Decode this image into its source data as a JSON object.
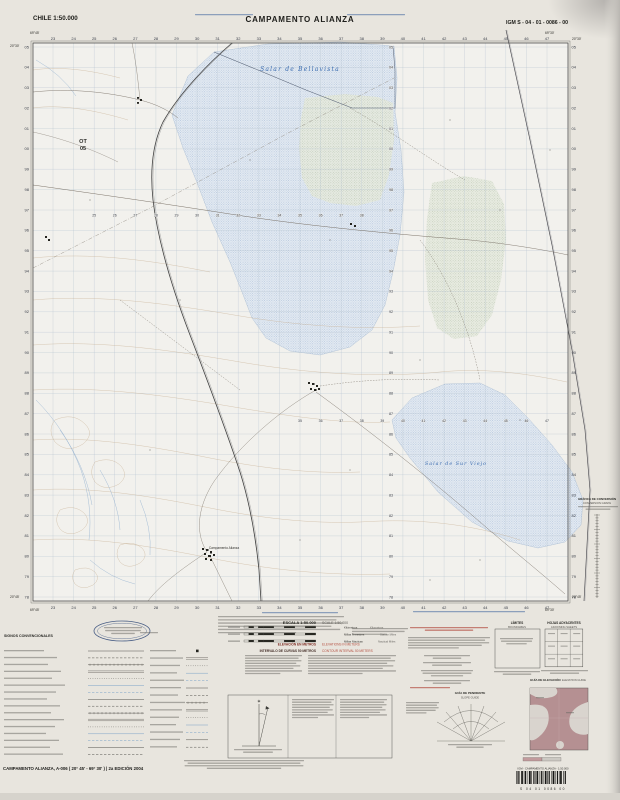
{
  "header": {
    "country_scale": "CHILE 1:50.000",
    "title": "CAMPAMENTO ALIANZA",
    "sheet_code": "IGM S - 04 - 01 - 0086 - 00"
  },
  "map": {
    "neighbor_sheet_ref": {
      "line1": "OT",
      "line2": "05"
    },
    "feature_labels": {
      "salar_north": "Salar de Bellavista",
      "salar_south": "Salar de Sur Viejo",
      "settlement": "Campamento Alianza"
    },
    "corners": {
      "lon_west": "69°45'",
      "lon_east": "69°30'",
      "lat_north": "20°30'",
      "lat_south": "20°45'"
    },
    "grid": {
      "eastings": [
        "23",
        "24",
        "25",
        "26",
        "27",
        "28",
        "29",
        "30",
        "31",
        "32",
        "33",
        "34",
        "35",
        "36",
        "37",
        "38",
        "39",
        "40",
        "41",
        "42",
        "43",
        "44",
        "45",
        "46",
        "47"
      ],
      "northings": [
        "05",
        "04",
        "03",
        "02",
        "01",
        "00",
        "99",
        "98",
        "97",
        "96",
        "95",
        "94",
        "93",
        "92",
        "91",
        "90",
        "89",
        "88",
        "87",
        "86",
        "85",
        "84",
        "83",
        "82",
        "81",
        "80",
        "79",
        "78"
      ]
    }
  },
  "marginalia": {
    "legend_title": "SIGNOS CONVENCIONALES",
    "scale_block": {
      "escala": "ESCALA 1:50.000",
      "scale": "SCALE 1:50,000",
      "bars": [
        {
          "es": "Kilómetros",
          "en": "Kilometers"
        },
        {
          "es": "Millas Terrestres",
          "en": "Statute Miles"
        },
        {
          "es": "Millas Náuticas",
          "en": "Nautical Miles"
        }
      ]
    },
    "elevation": {
      "es": "ELEVACIÓN EN METROS",
      "en": "ELEVATIONS IN METERS",
      "interval_es": "INTERVALO DE CURVAS 50 METROS",
      "interval_en": "CONTOUR INTERVAL 50 METERS"
    },
    "limits": {
      "es": "LÍMITES",
      "en": "BOUNDARIES"
    },
    "adjoining": {
      "es": "HOJAS ADYACENTES",
      "en": "ADJOINING SHEETS"
    },
    "slope_guide": {
      "es": "GUÍA DE PENDIENTE",
      "en": "SLOPE GUIDE"
    },
    "elevation_guide": {
      "es": "GUÍA DE ELEVACIÓN",
      "en": "ELEVATION GUIDE"
    },
    "conversion_graph": {
      "es": "GRÁFICA DE CONVERSIÓN",
      "en": "CONVERSION GRAPH"
    }
  },
  "footer": {
    "sheet_line": "CAMPAMENTO ALIANZA, A-006 ( 20° 45' - 69° 30' ) | 2a EDICIÓN 2004",
    "barcode_label": "IGM - CAMPAMENTO ALIANZA - 1:50.000",
    "barcode_digits": "S    04    01    0086    00"
  },
  "colors": {
    "paper": "#e8e5de",
    "map_background": "#f2f1ed",
    "grid_blue": "#b6c4d0",
    "water_blue": "#4c7ab2",
    "salar_fill": "#e3eaf2",
    "salar_dot": "#84a0c6",
    "green_fill": "#e6eadf",
    "green_dot": "#98a88b",
    "contour_tan": "#c3a98a",
    "red_note": "#b0463a",
    "elevation_guide_fill": "#b59092"
  }
}
